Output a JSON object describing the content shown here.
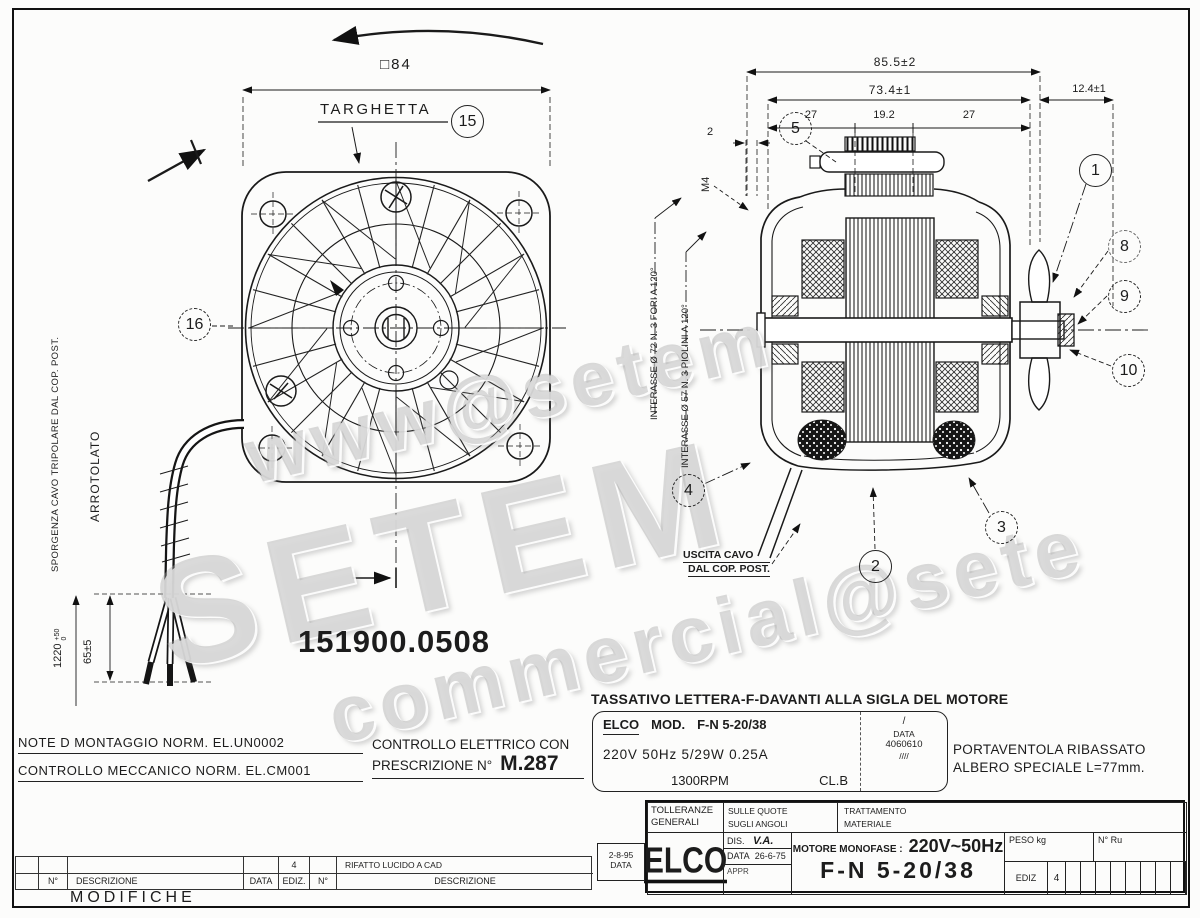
{
  "watermark": {
    "top": "www@setem",
    "main": "SETEM",
    "bottom": "commercial@sete"
  },
  "front_view": {
    "dim_flange_square": "□84",
    "targhetta_label": "TARGHETTA",
    "part_number": "151900.0508",
    "sporgenza_label": "SPORGENZA CAVO TRIPOLARE DAL COP. POST.",
    "arrotolato_label": "ARROTOLATO",
    "cable_length": "1220",
    "cable_tol_plus": "+50",
    "cable_tol_minus": "0",
    "strip_dim": "65±5"
  },
  "section_view": {
    "dim_overall": "85.5±2",
    "dim_body": "73.4±1",
    "dim_shaft_end": "12.4±1",
    "dim_seg_left": "27",
    "dim_seg_mid": "19.2",
    "dim_seg_right": "27",
    "dim_plate": "2",
    "thread_label": "M4",
    "interasse_fori": "INTERASSE Ø 72  N. 3 FORI A 120°",
    "interasse_piolini": "INTERASSE Ø 57  N. 3 PIOLINI A 120°",
    "uscita_line1": "USCITA CAVO",
    "uscita_line2": "DAL COP. POST."
  },
  "callouts": {
    "c1": "1",
    "c2": "2",
    "c3": "3",
    "c4": "4",
    "c5": "5",
    "c8": "8",
    "c9": "9",
    "c10": "10",
    "c15": "15",
    "c16": "16"
  },
  "notes": {
    "tassativo": "TASSATIVO LETTERA-F-DAVANTI ALLA SIGLA DEL MOTORE",
    "montaggio": "NOTE D MONTAGGIO NORM.  EL.UN0002",
    "meccanico": "CONTROLLO MECCANICO NORM. EL.CM001",
    "elettrico_line1": "CONTROLLO ELETTRICO CON",
    "elettrico_line2": "PRESCRIZIONE N°",
    "elettrico_value": "M.287",
    "portaventola_line1": "PORTAVENTOLA RIBASSATO",
    "portaventola_line2": "ALBERO SPECIALE L=77mm."
  },
  "nameplate": {
    "brand": "ELCO",
    "mod_label": "MOD.",
    "mod_value": "F-N 5-20/38",
    "electrical": "220V 50Hz  5/29W  0.25A",
    "rpm": "1300RPM",
    "ins_class": "CL.B",
    "slash": "/",
    "data_label": "DATA",
    "data_value": "4060610",
    "strokes": "////"
  },
  "title_block": {
    "tolleranze_1": "TOLLERANZE",
    "tolleranze_2": "GENERALI",
    "sulle_quote": "SULLE QUOTE",
    "sugli_angoli": "SUGLI ANGOLI",
    "trattamento": "TRATTAMENTO",
    "materiale": "MATERIALE",
    "logo": "ELCO",
    "dis_label": "DIS.",
    "dis_value": "V.A.",
    "data_label": "DATA",
    "data_value": "26-6-75",
    "appr_label": "APPR",
    "motore_label": "MOTORE MONOFASE :",
    "motore_value": "220V~50Hz",
    "model": "F-N 5-20/38",
    "peso_label": "PESO kg",
    "nru_label": "N° Ru",
    "ediz_label": "EDIZ",
    "ediz_value": "4",
    "rev_date": "2-8-95",
    "rev_date_label": "DATA"
  },
  "revision_strip": {
    "col_n1": "N°",
    "col_desc1": "DESCRIZIONE",
    "col_data": "DATA",
    "col_ediz": "EDIZ.",
    "entry_ediz": "4",
    "col_n2": "N°",
    "entry_desc": "RIFATTO LUCIDO A CAD",
    "col_desc2": "DESCRIZIONE",
    "footer": "MODIFICHE"
  }
}
